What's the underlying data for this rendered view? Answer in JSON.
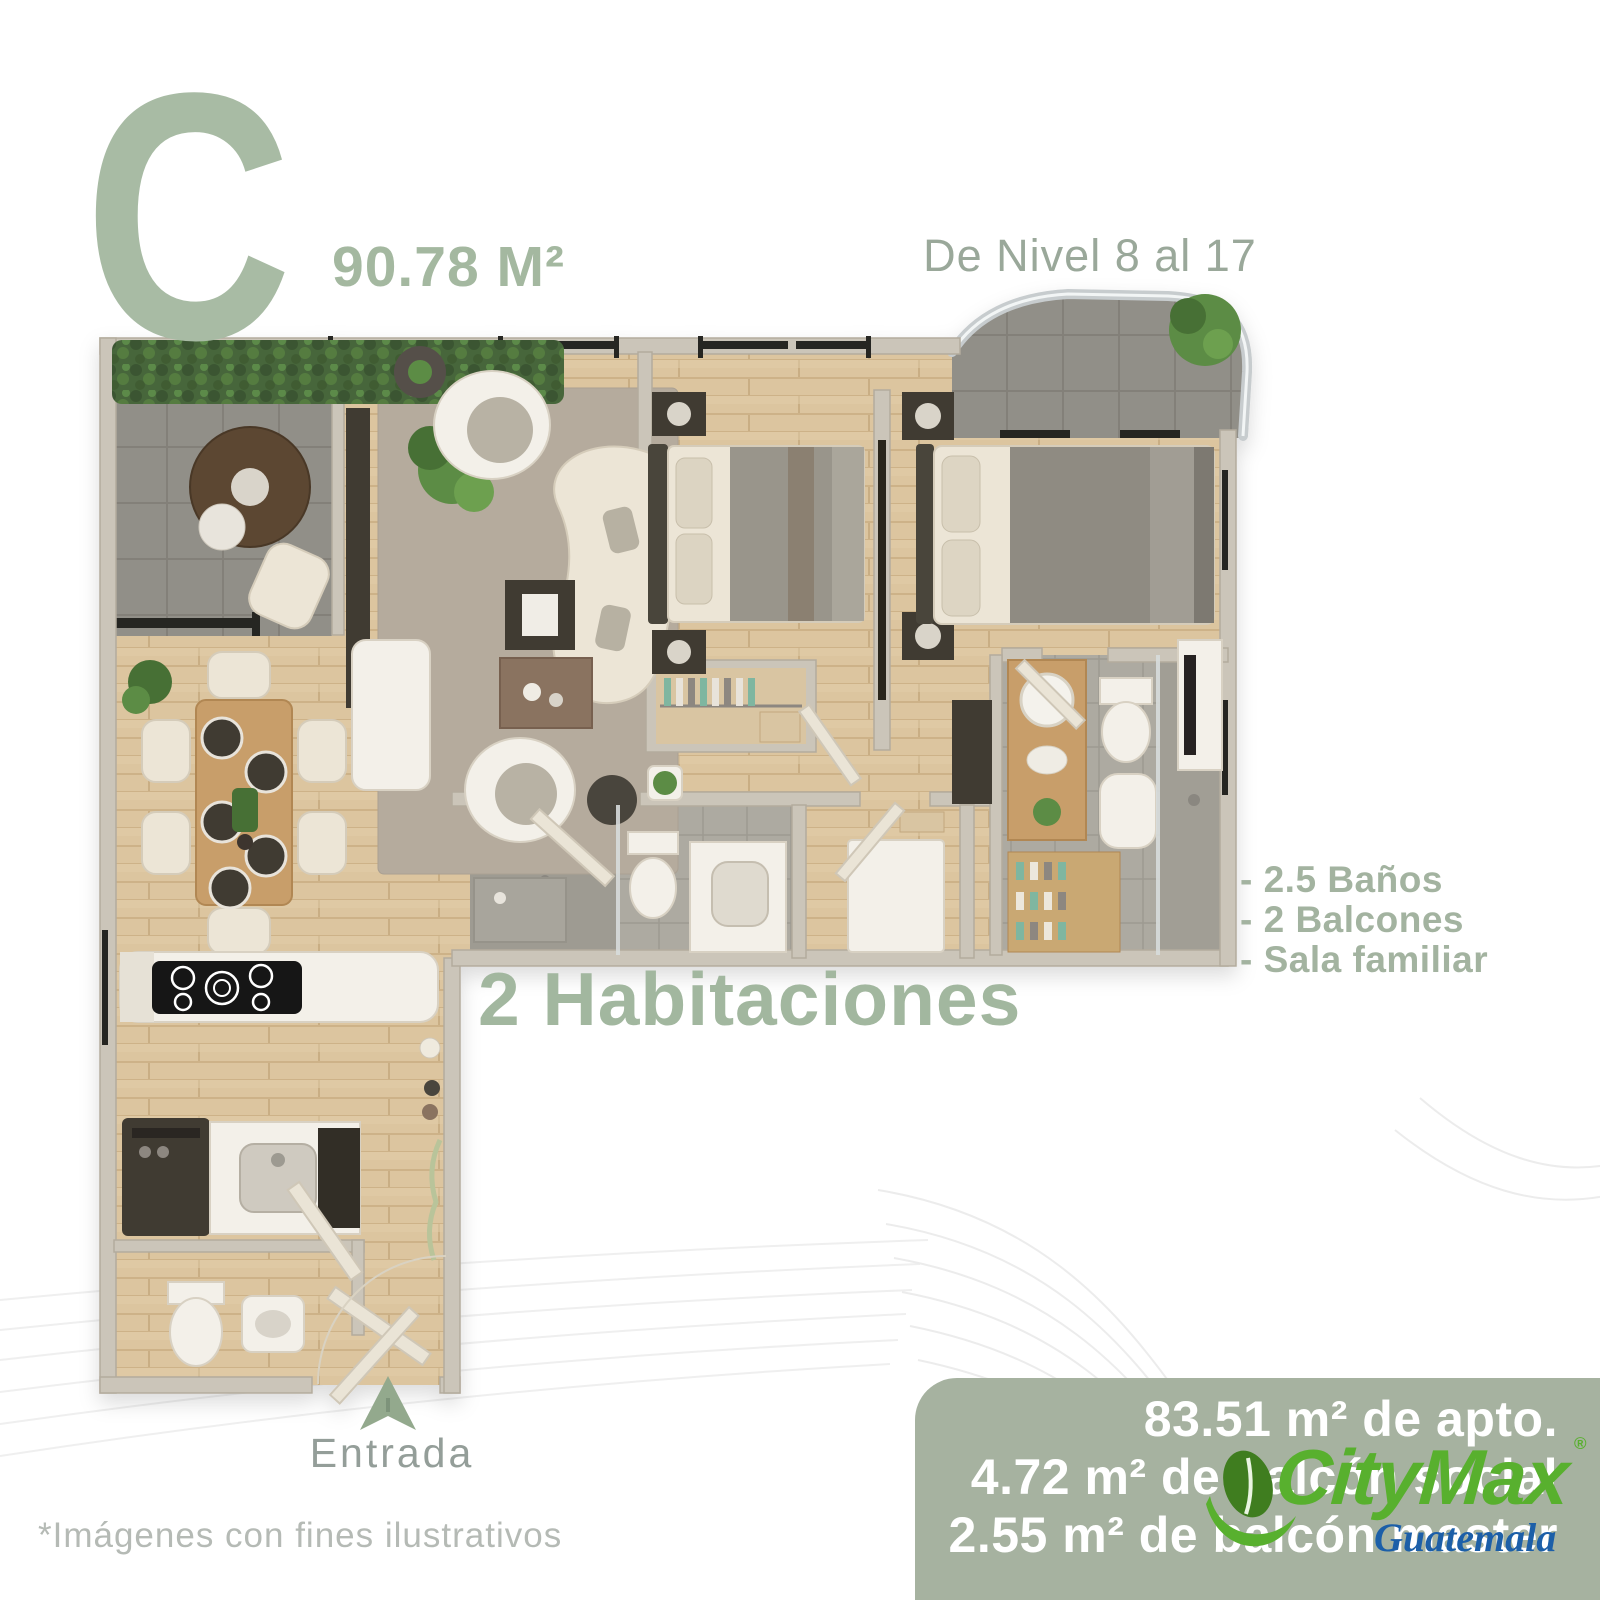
{
  "palette": {
    "sage": "#a8bba4",
    "sage_text": "#a2b79f",
    "label_gray_green": "#9aa89a",
    "entrance_gray": "#949e99",
    "disclaimer_gray": "#b5bab5",
    "metrics_box_green": "#a6b2a0",
    "metrics_text": "#ffffff",
    "citymax_green": "#58b02e",
    "citymax_leaf_dark": "#3f7d1f",
    "guatemala_blue": "#1c5fa8",
    "wood_floor": "#dcc59f",
    "balcony_tile": "#918f88",
    "wall_gray": "#cbc5b9"
  },
  "header": {
    "unit_letter": "C",
    "unit_area": "90.78 M²",
    "level_range": "De Nivel 8 al 17"
  },
  "features": {
    "items": [
      "- 2.5 Baños",
      "- 2 Balcones",
      "- Sala familiar"
    ]
  },
  "highlight": {
    "bedrooms": "2 Habitaciones"
  },
  "entrance": {
    "label": "Entrada",
    "arrow_icon": "location-arrow-up"
  },
  "disclaimer": {
    "text": "*Imágenes con fines ilustrativos"
  },
  "metrics_box": {
    "lines": [
      "83.51 m² de apto.",
      "4.72 m² de balcón social",
      "2.55 m² de balcón master"
    ]
  },
  "brand": {
    "name": "CityMax",
    "registered": "®",
    "region": "Guatemala",
    "icon": "citymax-leaf-swoosh"
  },
  "plan": {
    "rooms": [
      "balcon social",
      "sala",
      "habitacion 1",
      "habitacion master",
      "balcon master",
      "comedor",
      "cocina",
      "lavanderia",
      "medio baño",
      "baño compartido",
      "baño master",
      "sala familiar",
      "closets"
    ]
  }
}
